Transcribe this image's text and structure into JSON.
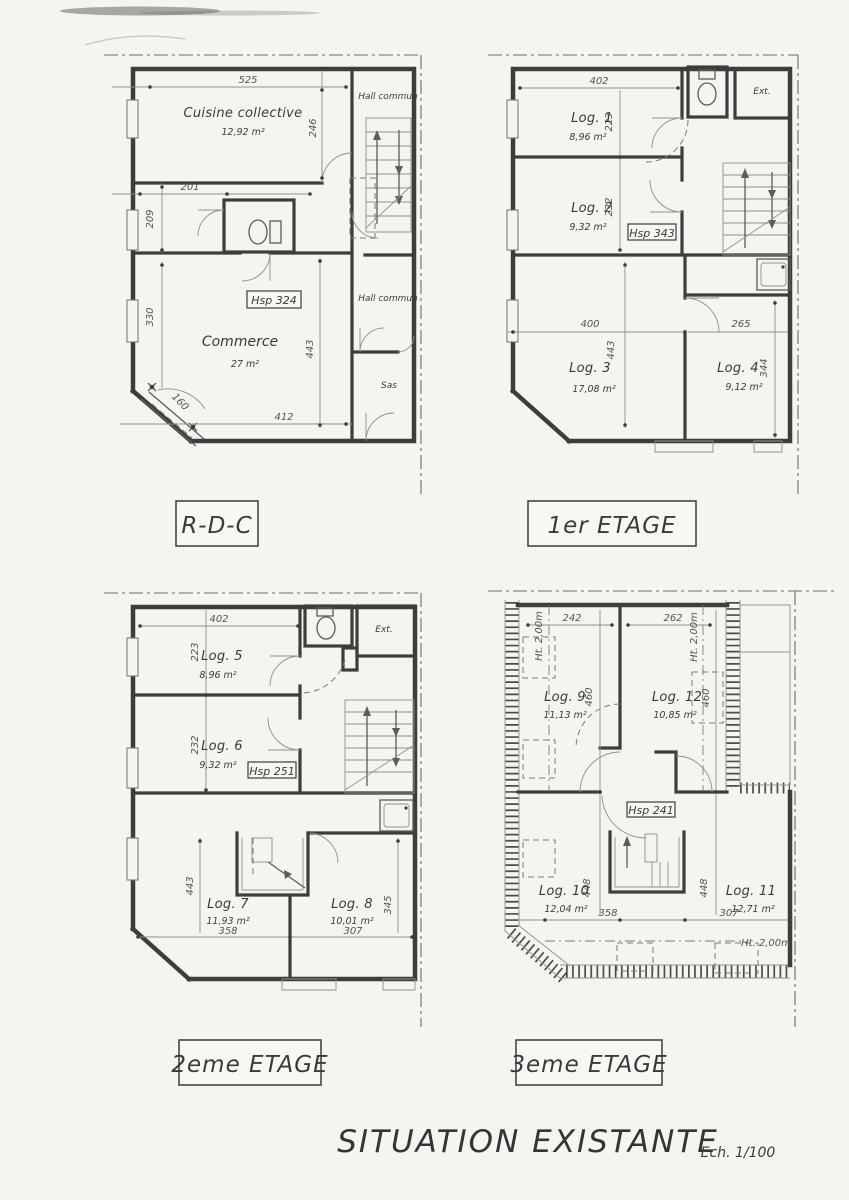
{
  "title": {
    "main": "SITUATION EXISTANTE",
    "scale": "Ech. 1/100"
  },
  "plans": {
    "rdc": {
      "label": "R-D-C",
      "cuisine_name": "Cuisine collective",
      "cuisine_area": "12,92 m²",
      "hall_top": "Hall commun",
      "hall_mid": "Hall commun",
      "sas": "Sas",
      "commerce_name": "Commerce",
      "commerce_area": "27 m²",
      "hsp": "Hsp 324",
      "d_top": "525",
      "d_right": "246",
      "d_wc": "201",
      "d_l1": "209",
      "d_l2": "330",
      "d_mid": "443",
      "d_cham": "160",
      "d_bot": "412"
    },
    "et1": {
      "label": "1er ETAGE",
      "log1_name": "Log. 1",
      "log1_area": "8,96 m²",
      "log2_name": "Log. 2",
      "log2_area": "9,32 m²",
      "log3_name": "Log. 3",
      "log3_area": "17,08 m²",
      "log4_name": "Log. 4",
      "log4_area": "9,12 m²",
      "ext": "Ext.",
      "hsp": "Hsp 343",
      "d_top": "402",
      "d_log1": "223",
      "d_log2": "232",
      "d_log3w": "400",
      "d_log4w": "265",
      "d_log3h": "443",
      "d_log4h": "344"
    },
    "et2": {
      "label": "2eme ETAGE",
      "log5_name": "Log. 5",
      "log5_area": "8,96 m²",
      "log6_name": "Log. 6",
      "log6_area": "9,32 m²",
      "log7_name": "Log. 7",
      "log7_area": "11,93 m²",
      "log7_w": "358",
      "log8_name": "Log. 8",
      "log8_area": "10,01 m²",
      "log8_w": "307",
      "ext": "Ext.",
      "hsp": "Hsp 251",
      "d_top": "402",
      "d_log5": "223",
      "d_log6": "232",
      "d_log7h": "443",
      "d_log8h": "345"
    },
    "et3": {
      "label": "3eme ETAGE",
      "log9_name": "Log. 9",
      "log9_area": "11,13 m²",
      "log10_name": "Log. 10",
      "log10_area": "12,04 m²",
      "log10_w": "358",
      "log11_name": "Log. 11",
      "log11_area": "12,71 m²",
      "log11_w": "307",
      "log12_name": "Log. 12",
      "log12_area": "10,85 m²",
      "hsp": "Hsp 241",
      "ht_left": "Ht. 2,00m",
      "ht_right": "Ht. 2,00m",
      "ht_bottom": "Ht. 2,00m",
      "d_log9w": "242",
      "d_log12w": "262",
      "d_log9h": "460",
      "d_log12h": "460",
      "d_log10h": "448",
      "d_log11h": "448"
    }
  }
}
